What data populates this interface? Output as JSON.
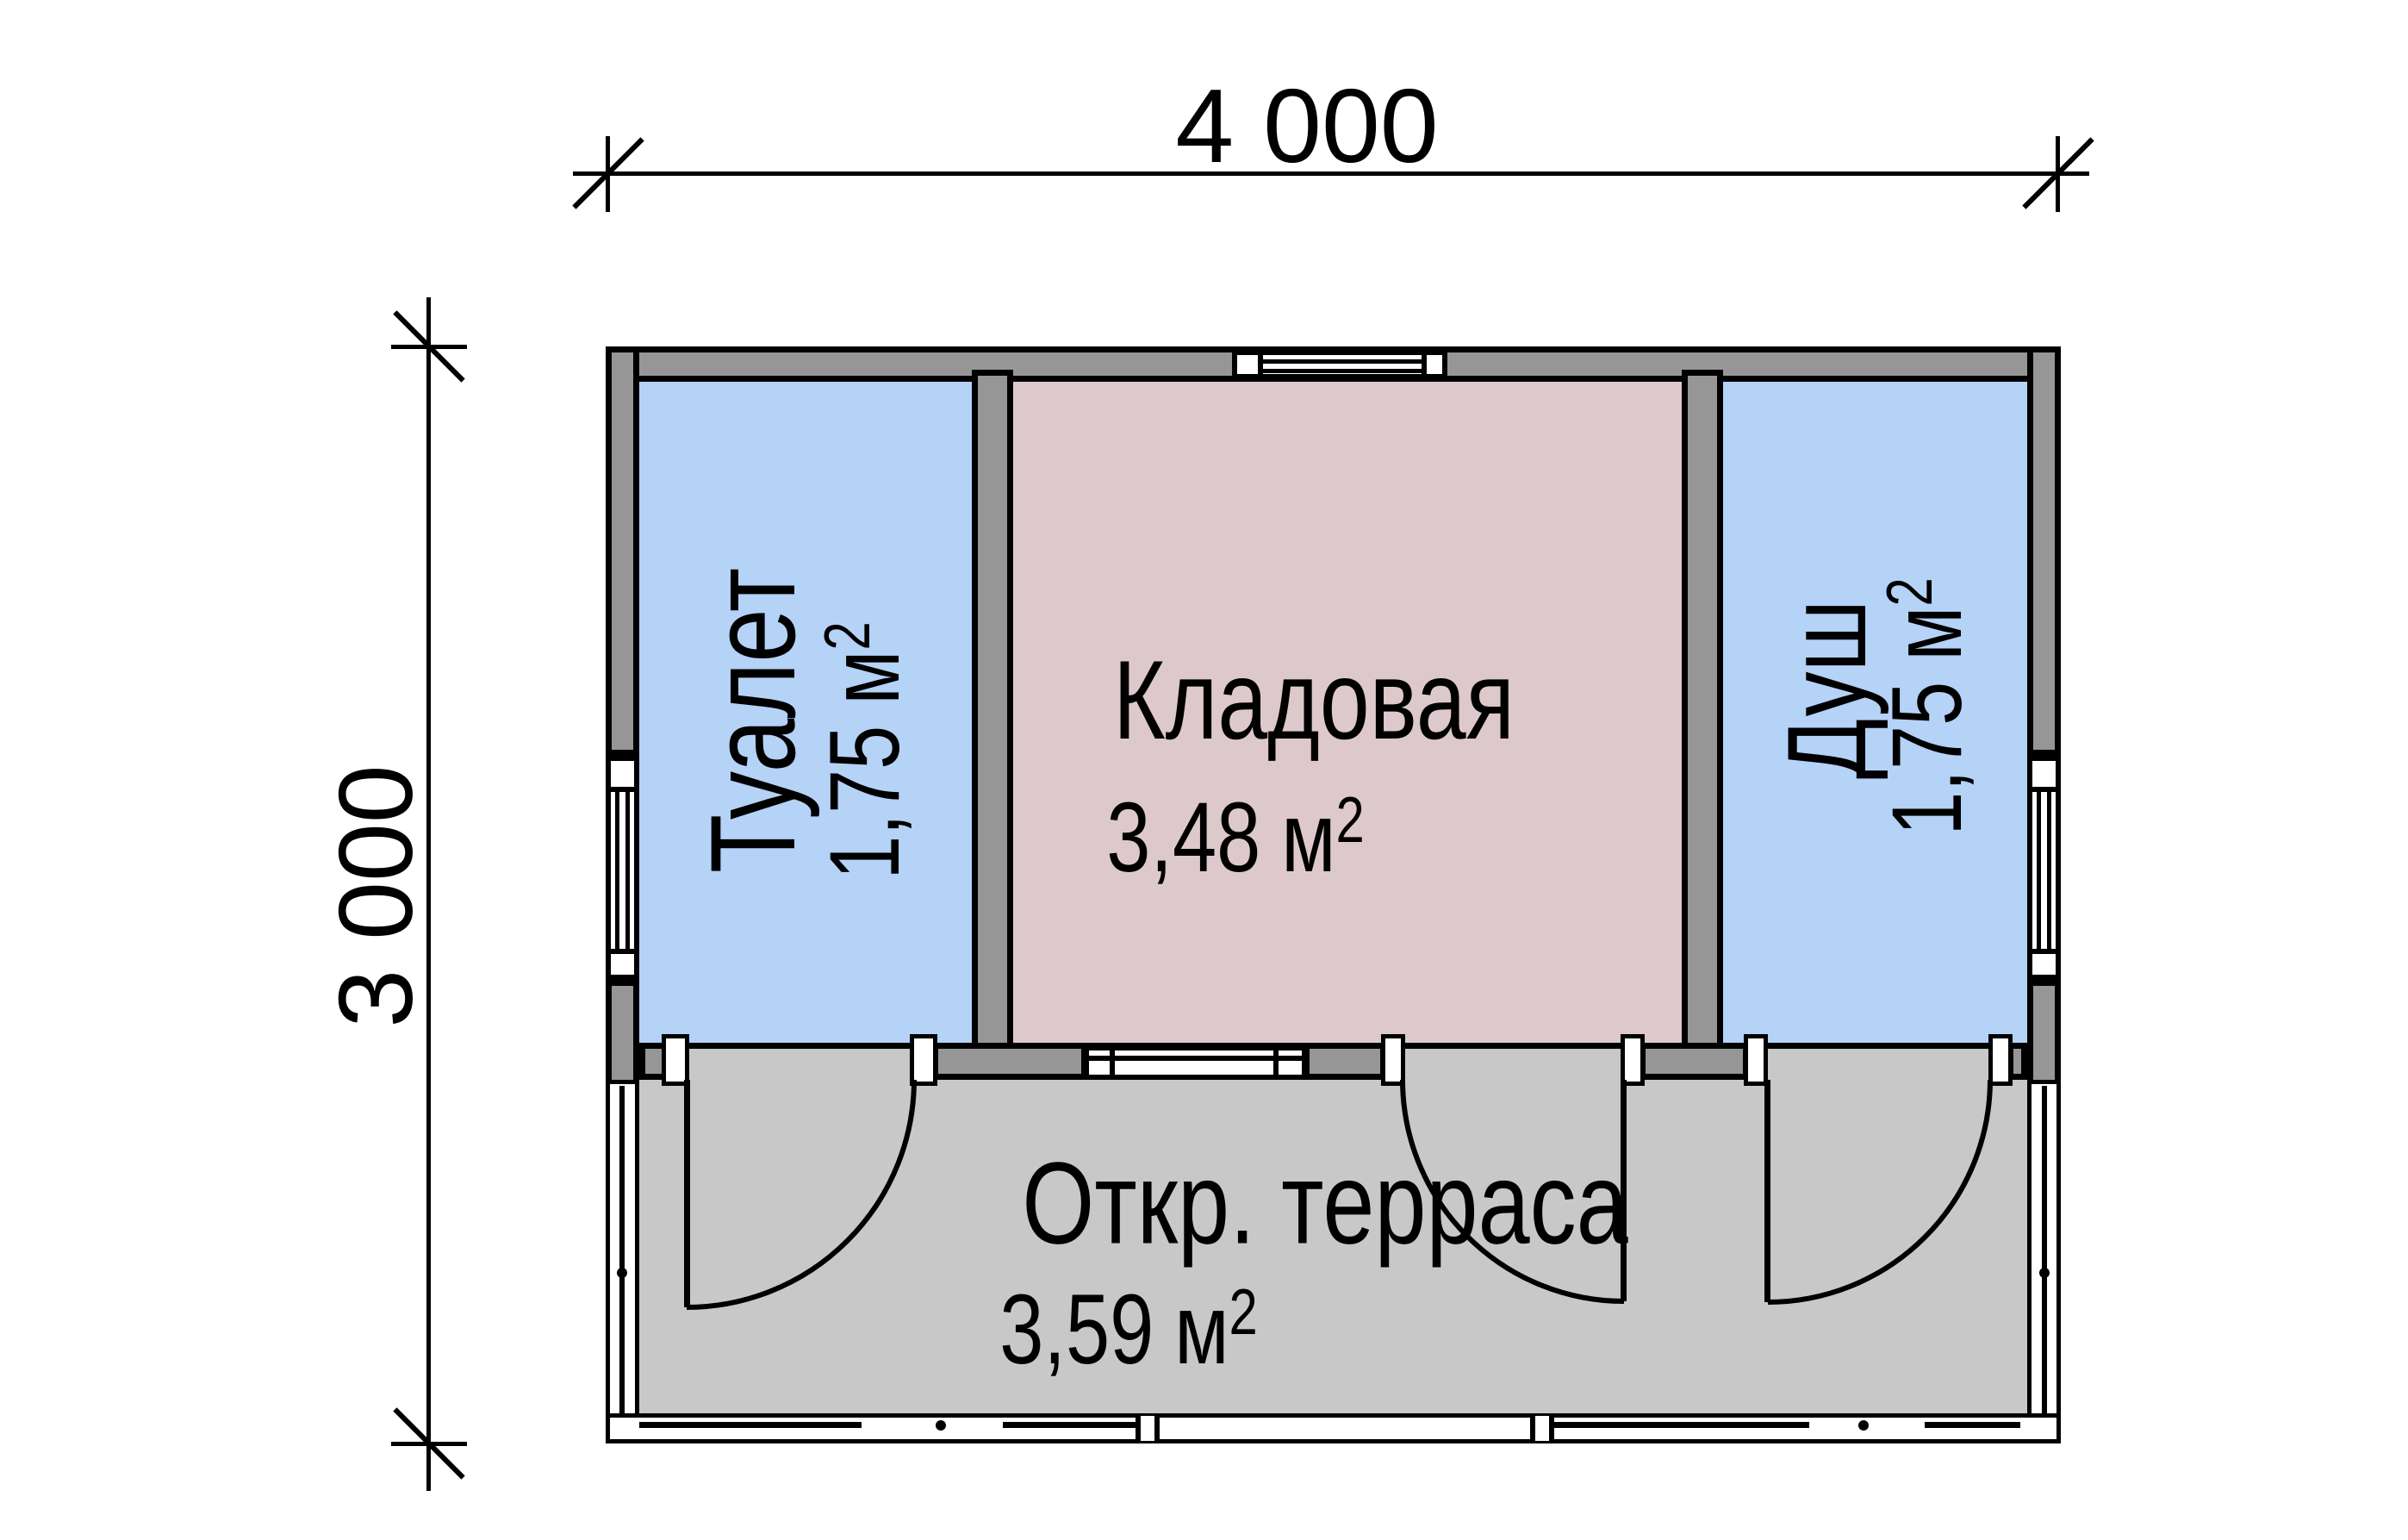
{
  "plan": {
    "dimensions": {
      "width_label": "4 000",
      "height_label": "3 000"
    },
    "rooms": [
      {
        "name": "Туалет",
        "area_value": "1,75",
        "area_unit": "м",
        "area_sup": "2",
        "color": "#b5d2f7"
      },
      {
        "name": "Кладовая",
        "area_value": "3,48",
        "area_unit": "м",
        "area_sup": "2",
        "color": "#ddc9cc"
      },
      {
        "name": "Душ",
        "area_value": "1,75",
        "area_unit": "м",
        "area_sup": "2",
        "color": "#b5d2f7"
      },
      {
        "name": "Откр. терраса",
        "area_value": "3,59",
        "area_unit": "м",
        "area_sup": "2",
        "color": "#c8c8c8"
      }
    ],
    "colors": {
      "walls": "#969696",
      "lines": "#000000",
      "background": "#ffffff"
    }
  }
}
